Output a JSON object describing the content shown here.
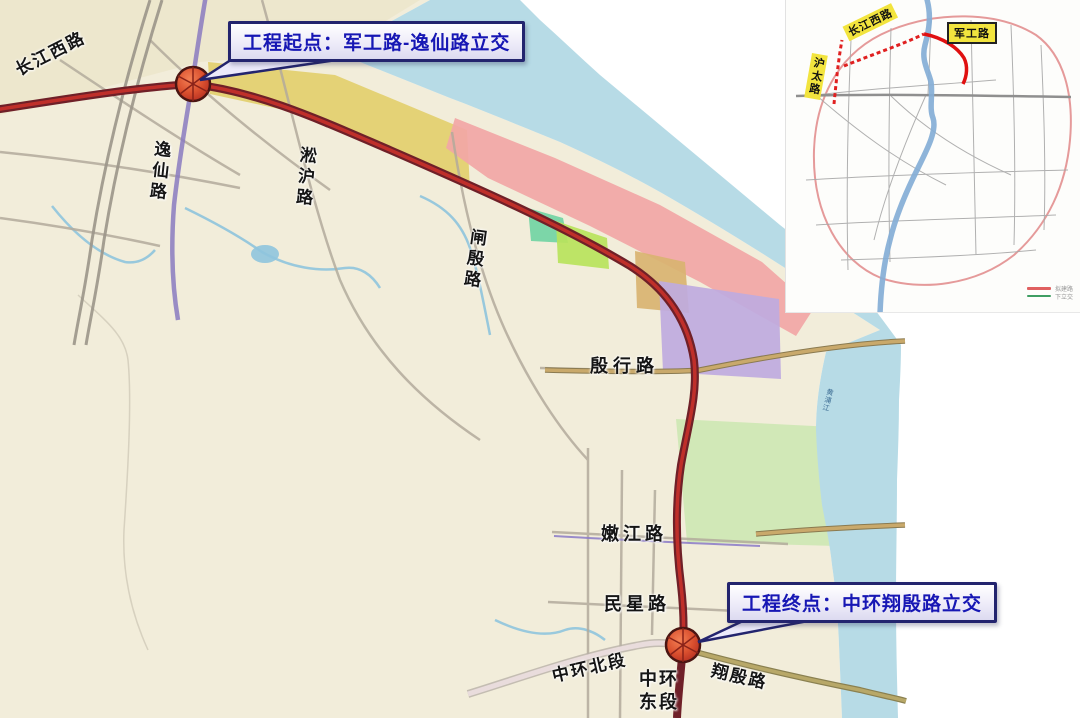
{
  "callouts": {
    "start": {
      "text": "工程起点：军工路-逸仙路立交"
    },
    "end": {
      "text": "工程终点：中环翔殷路立交"
    }
  },
  "main_map": {
    "road_labels": {
      "changjiang_west": "长江西路",
      "yixian": "逸仙路",
      "songhu": "淞沪路",
      "zhayin": "闸殷路",
      "yinhang": "殷行路",
      "nenjiang": "嫩江路",
      "minxing": "民星路",
      "zhonghuan_north": "中环北段",
      "zhonghuan_east": "中环东段",
      "xiangyin": "翔殷路",
      "huangpu_river": "黄浦江"
    }
  },
  "inset_map": {
    "road_labels": {
      "changjiang_west": "长江西路",
      "jungong": "军工路",
      "hutai": "沪太路"
    },
    "legend": [
      {
        "color": "#e06060",
        "label": "拟建路"
      },
      {
        "color": "#3f9e63",
        "label": "下立交"
      }
    ]
  },
  "colors": {
    "water": "#b7dbe6",
    "land": "#f2edda",
    "route_dark": "#6f2028",
    "route_red": "#c3302a",
    "marker_red": "#d14a2e",
    "callout_text": "#1717b4",
    "callout_border": "#23246e",
    "highlight_yellow": "#f2e43e",
    "zone_yellow": "#e3cf6e",
    "zone_salmon": "#f2a6a6",
    "zone_green": "#6fd3a2",
    "zone_yellowgreen": "#b8e35c",
    "zone_tan": "#d9b371",
    "zone_purple": "#bfaae0",
    "zone_park": "#cfe8b5"
  }
}
